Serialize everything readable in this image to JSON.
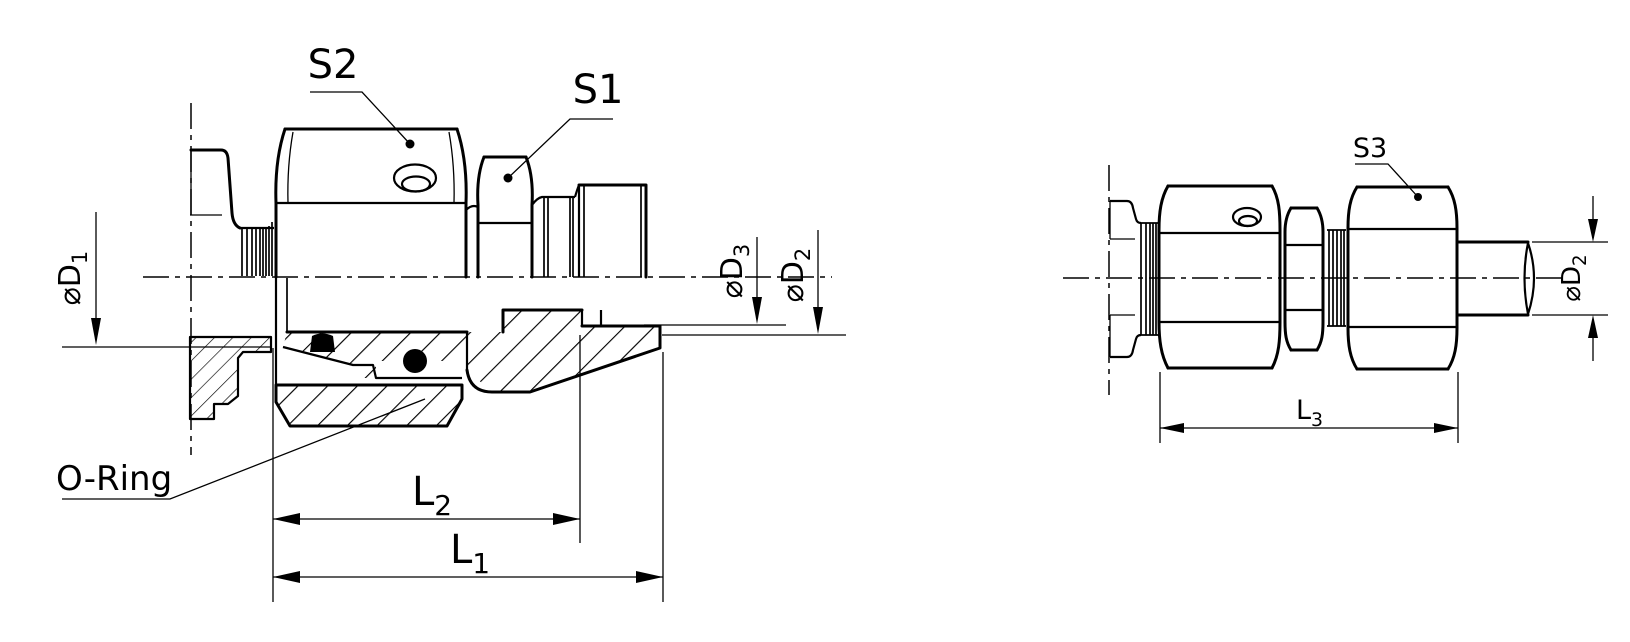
{
  "drawing": {
    "background": "#ffffff",
    "line_color": "#000000",
    "figure_left": {
      "labels": {
        "s2": "S2",
        "s1": "S1",
        "oring": "O-Ring",
        "d1_main": "⌀D",
        "d1_sub": "1",
        "d3_main": "⌀D",
        "d3_sub": "3",
        "d2_main": "⌀D",
        "d2_sub": "2",
        "l2_main": "L",
        "l2_sub": "2",
        "l1_main": "L",
        "l1_sub": "1"
      }
    },
    "figure_right": {
      "labels": {
        "s3": "S3",
        "d2_main": "⌀D",
        "d2_sub": "2",
        "l3_main": "L",
        "l3_sub": "3"
      }
    }
  }
}
